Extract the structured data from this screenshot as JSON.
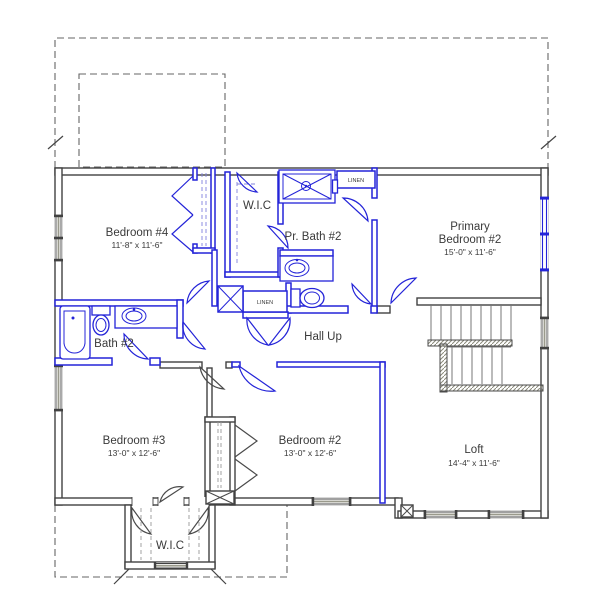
{
  "title": "Second floor plan with highlighted bath and bedroom walls",
  "colors": {
    "wall_dark": "#414141",
    "highlight_blue": "#2424d8",
    "window_gray": "#9a9a8c",
    "dashed_outline": "#666666",
    "text": "#3a3a3a",
    "background": "#ffffff"
  },
  "rooms": {
    "bedroom4": {
      "name": "Bedroom #4",
      "dims": "11'-8\" x 11'-6\""
    },
    "wic_upper": {
      "name": "W.I.C"
    },
    "pr_bath2": {
      "name": "Pr. Bath #2"
    },
    "primary_bedroom2": {
      "name_line1": "Primary",
      "name_line2": "Bedroom #2",
      "dims": "15'-0\" x 11'-6\""
    },
    "bath2": {
      "name": "Bath #2"
    },
    "hall": {
      "name": "Hall Up"
    },
    "bedroom3": {
      "name": "Bedroom #3",
      "dims": "13'-0\" x 12'-6\""
    },
    "bedroom2": {
      "name": "Bedroom #2",
      "dims": "13'-0\" x 12'-6\""
    },
    "loft": {
      "name": "Loft",
      "dims": "14'-4\" x 11'-6\""
    },
    "wic_lower": {
      "name": "W.I.C"
    },
    "linen_upper": {
      "name": "LINEN"
    },
    "linen_hall": {
      "name": "LINEN"
    }
  }
}
